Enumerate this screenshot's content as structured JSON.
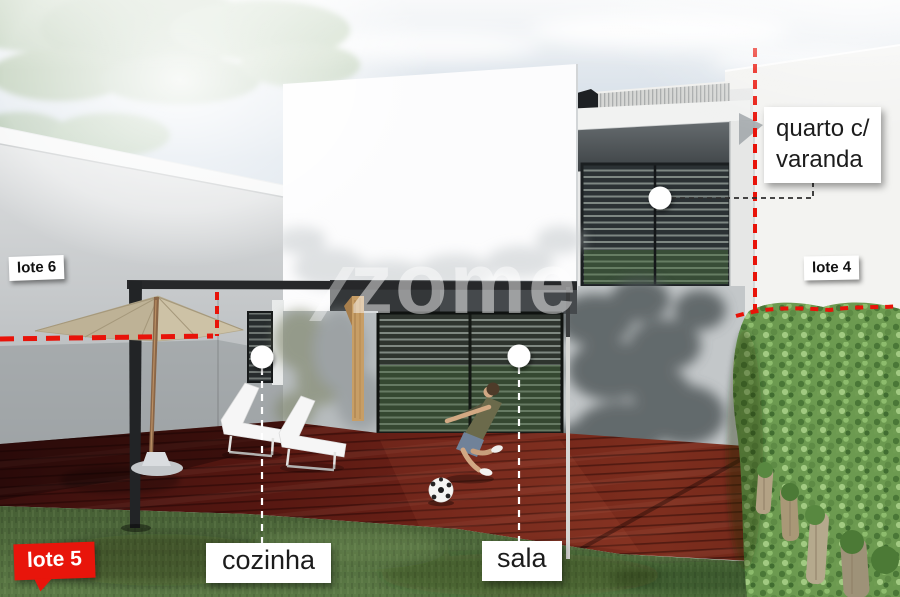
{
  "watermark": {
    "text": "zome"
  },
  "annotations": {
    "bedroom": {
      "line1": "quarto c/",
      "line2": "varanda"
    },
    "kitchen": {
      "label": "cozinha"
    },
    "living_room": {
      "label": "sala"
    }
  },
  "lot_tags": {
    "left": {
      "label": "lote 6"
    },
    "right": {
      "label": "lote 4"
    },
    "front": {
      "label": "lote 5"
    }
  },
  "colors": {
    "boundary_red": "#e81309",
    "front_tag_red": "#e8150b",
    "label_bg": "#ffffff",
    "label_text": "#1c1c1c",
    "deck_wood": "#6b2217",
    "lawn_green": "#52703d",
    "hedge_green": "#6c9a50"
  }
}
